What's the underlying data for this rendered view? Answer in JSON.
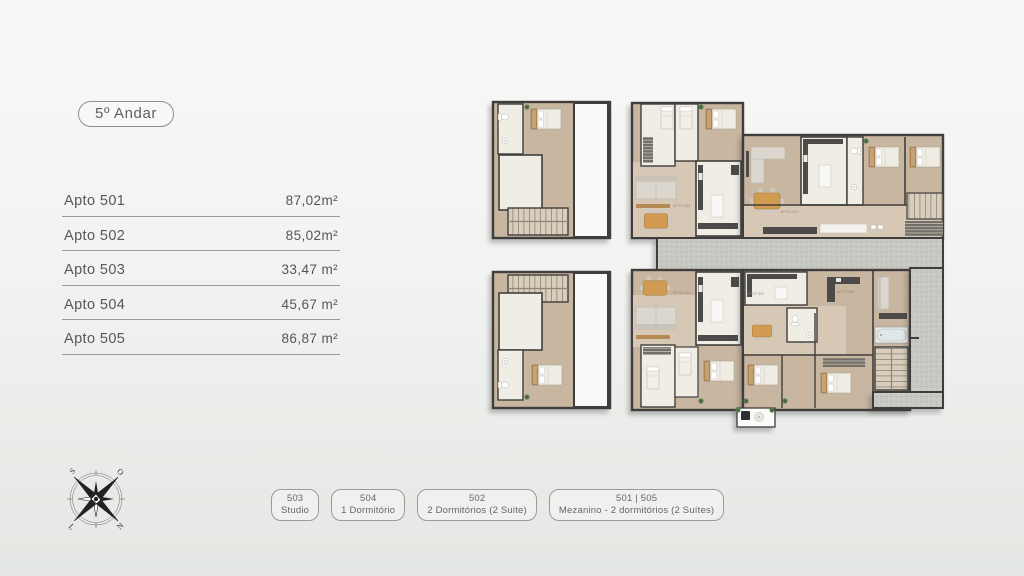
{
  "page": {
    "floor_badge": "5º Andar"
  },
  "apartments": [
    {
      "label": "Apto 501",
      "area": "87,02m²"
    },
    {
      "label": "Apto 502",
      "area": "85,02m²"
    },
    {
      "label": "Apto 503",
      "area": "33,47 m²"
    },
    {
      "label": "Apto 504",
      "area": "45,67 m²"
    },
    {
      "label": "Apto 505",
      "area": "86,87 m²"
    }
  ],
  "legend": [
    {
      "line1": "503",
      "line2": "Studio"
    },
    {
      "line1": "504",
      "line2": "1 Dormitório"
    },
    {
      "line1": "502",
      "line2": "2 Dormitórios (2 Suite)"
    },
    {
      "line1": "501 | 505",
      "line2": "Mezanino - 2 dormitórios (2 Suítes)"
    }
  ],
  "compass": {
    "letters": [
      "S",
      "O",
      "L",
      "N"
    ]
  },
  "floorplan": {
    "room_labels": [
      "APTO 505",
      "APTO 501",
      "APTO 504",
      "APTO 502",
      "APTO 505"
    ]
  },
  "colors": {
    "wall": "#3f3e3c",
    "floor": "#c9b6a0",
    "floor_light": "#d7c8b5",
    "room_white": "#f0ede5",
    "terrace": "#c9c9c4",
    "wood": "#b68a55",
    "table": "#d29b52",
    "plant": "#5c7c4c",
    "counter": "#4c4b49",
    "sofa": "#dbd7cf",
    "text": "#5c5c5c",
    "line": "#9a9a9a",
    "border": "#8f8f8f"
  }
}
